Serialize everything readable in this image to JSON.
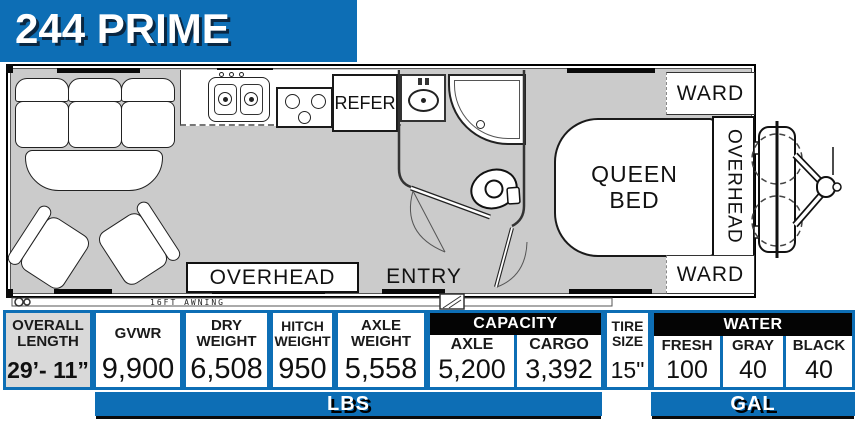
{
  "banner": {
    "title": "244 PRIME"
  },
  "floorplan": {
    "labels": {
      "refer": "REFER",
      "overhead_galley": "OVERHEAD",
      "entry": "ENTRY",
      "queen_bed": "QUEEN BED",
      "overhead_bedroom": "OVERHEAD",
      "ward_top": "WARD",
      "ward_bottom": "WARD",
      "awning": "16FT AWNING"
    }
  },
  "specs": {
    "overall_length": {
      "label": "OVERALL LENGTH",
      "value": "29’- 11”"
    },
    "weights": [
      {
        "label": "GVWR",
        "value": "9,900"
      },
      {
        "label": "DRY WEIGHT",
        "value": "6,508"
      },
      {
        "label": "HITCH WEIGHT",
        "value": "950"
      },
      {
        "label": "AXLE WEIGHT",
        "value": "5,558"
      }
    ],
    "capacity": {
      "title": "CAPACITY",
      "cols": [
        {
          "label": "AXLE",
          "value": "5,200"
        },
        {
          "label": "CARGO",
          "value": "3,392"
        }
      ]
    },
    "tire": {
      "label": "TIRE SIZE",
      "value": "15\""
    },
    "water": {
      "title": "WATER",
      "cols": [
        {
          "label": "FRESH",
          "value": "100"
        },
        {
          "label": "GRAY",
          "value": "40"
        },
        {
          "label": "BLACK",
          "value": "40"
        }
      ]
    },
    "units": {
      "lbs": "LBS",
      "gal": "GAL"
    }
  },
  "colors": {
    "accent_blue": "#0d6eb5",
    "header_black": "#040404",
    "floor_gray": "#cbcbcb"
  }
}
